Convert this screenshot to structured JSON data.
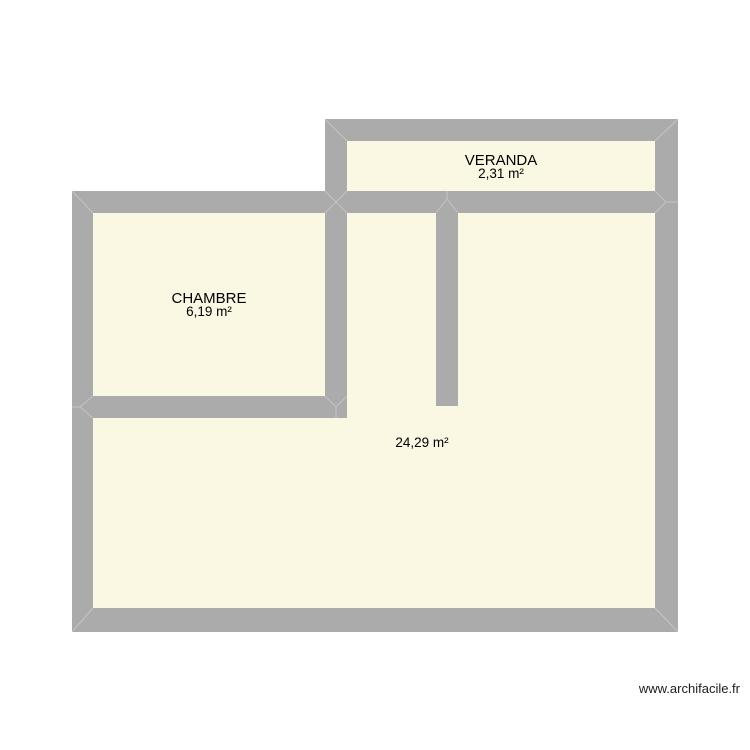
{
  "plan": {
    "rooms": [
      {
        "name": "VERANDA",
        "area": "2,31 m²"
      },
      {
        "name": "CHAMBRE",
        "area": "6,19 m²"
      },
      {
        "area": "24,29 m²"
      }
    ],
    "watermark": "www.archifacile.fr",
    "colors": {
      "wall": "#ababab",
      "room": "#faf7e3",
      "seam": "#c9c9c9",
      "text": "#000000",
      "background": "#ffffff"
    }
  }
}
